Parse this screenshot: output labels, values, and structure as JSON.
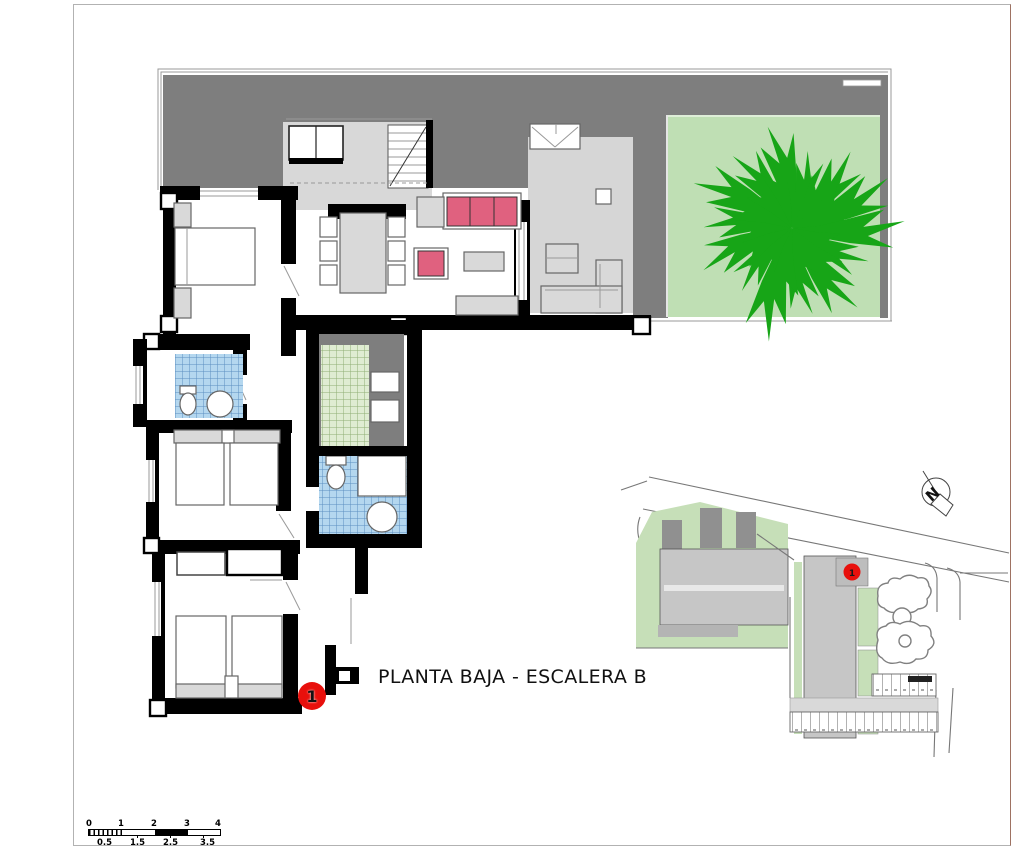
{
  "page": {
    "background": "#ffffff",
    "frame_color": "#b2b2b2",
    "frame_right_color": "#9e7262"
  },
  "title": {
    "text": "PLANTA BAJA - ESCALERA B"
  },
  "unit_marker": {
    "number": "1"
  },
  "site_plan": {
    "marker_number": "1",
    "compass_label": "N"
  },
  "scale_bar": {
    "top_labels": [
      "0",
      "1",
      "2",
      "3",
      "4"
    ],
    "bottom_labels": [
      "0.5",
      "1.5",
      "2.5",
      "3.5"
    ]
  },
  "palette": {
    "terrace_dark": "#7e7e7e",
    "terrace_light": "#d6d6d6",
    "stair_gray": "#d8d8d8",
    "garden_green": "#bfdfb4",
    "tree_green": "#17a517",
    "sofa_pink": "#e0617f",
    "tile_blue": "#b4d7ef",
    "tile_blue_line": "#5c8fc0",
    "tile_green": "#dfecd2",
    "tile_green_line": "#8fae74",
    "wall_black": "#000000",
    "furniture_gray": "#d9d9d9",
    "site_green": "#c6dfb8",
    "building_gray": "#c6c6c6",
    "marker_red": "#e8100c",
    "frame": "#b2b2b2",
    "frame_right": "#9e7262",
    "marker_text": "#1a1a1a"
  }
}
